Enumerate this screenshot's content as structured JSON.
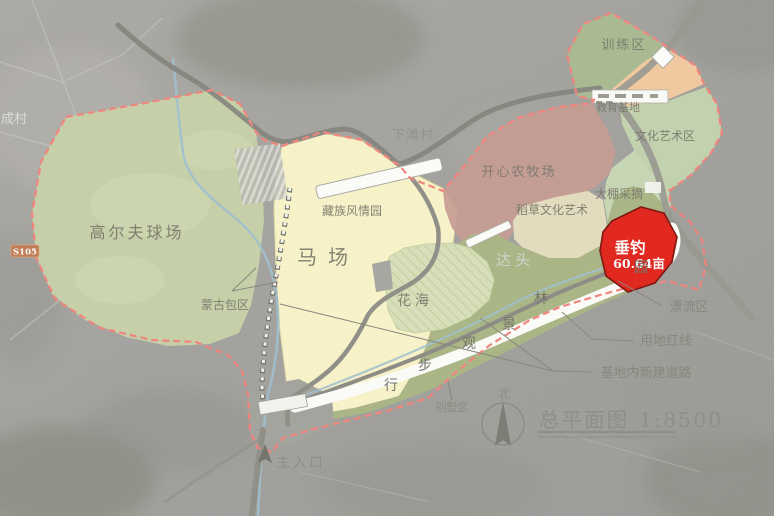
{
  "map": {
    "title": "总平面图",
    "scale": "1:8500",
    "north": "北",
    "road_badge": "S105",
    "entrance_label": "主入口",
    "villages": {
      "cheng": "成村",
      "xiatan": "下滩村",
      "datou": "达头"
    },
    "zones": {
      "golf": "高尔夫球场",
      "horse": "马场",
      "tibetan": "藏族风情园",
      "yurt": "蒙古包区",
      "flower": "花海",
      "farm": "开心农牧场",
      "straw": "稻草文化艺术",
      "greenhouse": "大棚采摘",
      "culture": "文化艺术区",
      "training": "训练区",
      "education": "教育基地",
      "villa": "别墅区"
    },
    "highlight": {
      "label": "垂钓",
      "area": "60.64亩",
      "color": "#e2231a"
    },
    "annotations": {
      "rafting": "漂流区",
      "red_line": "用地红线",
      "new_roads": "基地内新建道路"
    },
    "walkway": {
      "text": "园林景观步行",
      "chars": [
        "园",
        "林",
        "景",
        "观",
        "步",
        "行"
      ]
    },
    "colors": {
      "highlight_red": "#e2231a",
      "boundary_pink": "#f2837b",
      "golf_green": "#c6d0a8",
      "horse_yellow": "#f9f3c9",
      "farm_rose": "#c69b91",
      "park_olive": "#a9b584",
      "training_green": "#a8ba90",
      "orange_zone": "#f2c9a0",
      "badge_orange": "#c07a52",
      "stream_blue": "#9fc0cf"
    }
  }
}
